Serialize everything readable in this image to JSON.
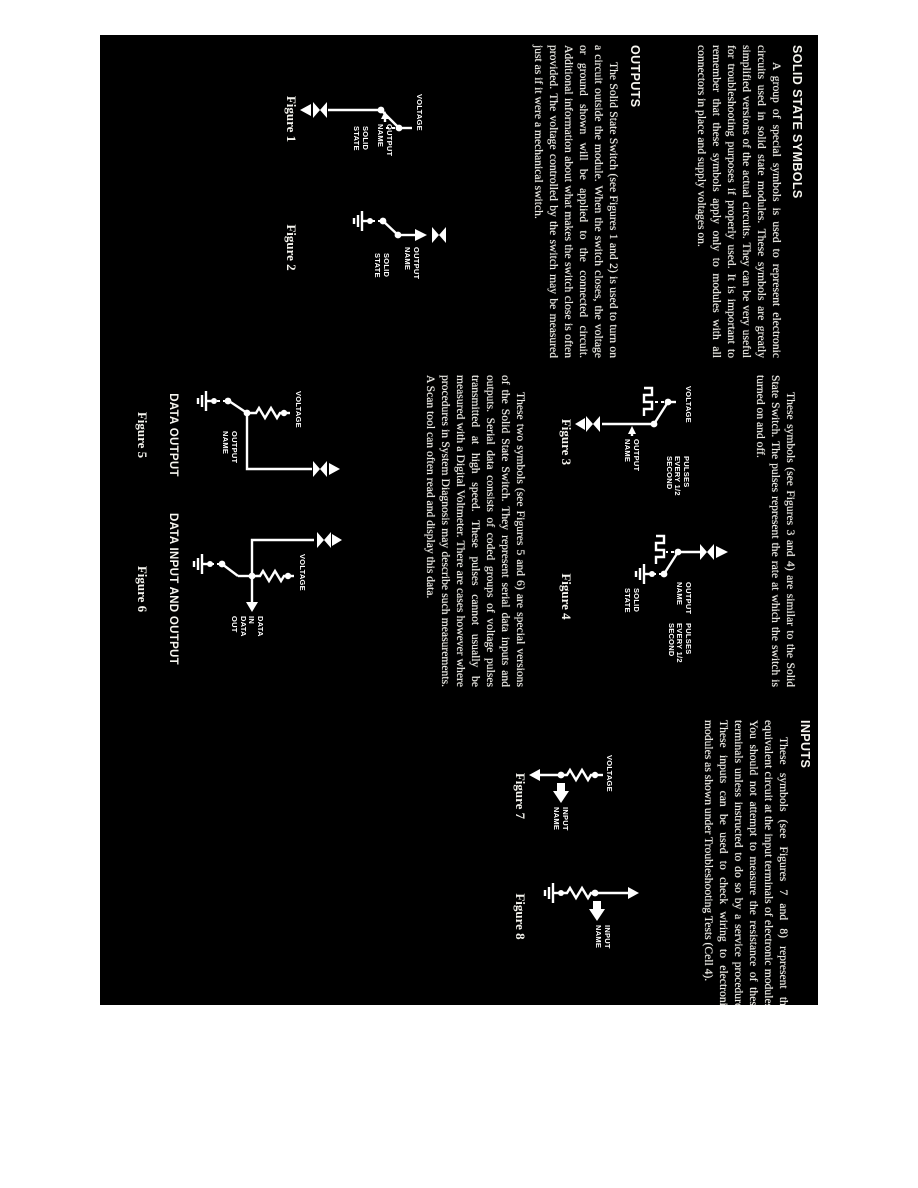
{
  "document": {
    "colors": {
      "paper": "#ffffff",
      "scan_bg": "#000000",
      "scan_text": "#f2f1ea"
    },
    "columns": {
      "col1": {
        "heading1": "SOLID STATE SYMBOLS",
        "para1": "A group of special symbols is used to represent electronic circuits used in solid state modules. These symbols are greatly simplified versions of the actual circuits. They can be very useful for troubleshooting purposes if properly used. It is important to remember that these symbols apply only to modules with all connectors in place and supply voltages on.",
        "heading2": "OUTPUTS",
        "para2": "The Solid State Switch (see Figures 1 and 2) is used to turn on a circuit outside the module. When the switch closes, the voltage or ground shown will be applied to the connected circuit. Additional information about what makes the switch close is often provided. The voltage controlled by the switch may be measured just as if it were a mechanical switch."
      },
      "col2": {
        "para1": "These symbols (see Figures 3 and 4) are similar to the Solid State Switch. The pulses represent the rate at which the switch is turned on and off.",
        "para2": "These two symbols (see Figures 5 and 6) are special versions of the Solid State Switch. They represent serial data inputs and outputs. Serial data consists of coded groups of voltage pulses transmitted at high speed. These pulses cannot usually be measured with a Digital Voltmeter. There are cases however where procedures in System Diagnosis may describe such measurements. A Scan tool can often read and display this data."
      },
      "col3": {
        "heading": "INPUTS",
        "para": "These symbols (see Figures 7 and 8) represent the equivalent circuit at the input terminals of electronic modules. You should not attempt to measure the resistance of these terminals unless instructed to do so by a service procedure. These inputs can be used to check wiring to electronic modules as shown under Troubleshooting Tests (Cell 4)."
      }
    },
    "figures": [
      {
        "caption": "Figure 1",
        "labels": {
          "voltage": "VOLTAGE",
          "output_name": "OUTPUT\nNAME",
          "solid_state": "SOLID\nSTATE"
        }
      },
      {
        "caption": "Figure 2",
        "labels": {
          "output_name": "OUTPUT\nNAME",
          "solid_state": "SOLID\nSTATE"
        }
      },
      {
        "caption": "Figure 3",
        "labels": {
          "voltage": "VOLTAGE",
          "pulses": "PULSES\nEVERY 1/2\nSECOND",
          "output_name": "OUTPUT\nNAME"
        }
      },
      {
        "caption": "Figure 4",
        "labels": {
          "output_name": "OUTPUT\nNAME",
          "pulses": "PULSES\nEVERY 1/2\nSECOND",
          "solid_state": "SOLID\nSTATE"
        }
      },
      {
        "caption": "Figure 5",
        "title": "DATA OUTPUT",
        "labels": {
          "voltage": "VOLTAGE",
          "output_name": "OUTPUT\nNAME"
        }
      },
      {
        "caption": "Figure 6",
        "title": "DATA INPUT AND OUTPUT",
        "labels": {
          "voltage": "VOLTAGE",
          "data": "DATA\nIN\nDATA\nOUT"
        }
      },
      {
        "caption": "Figure 7",
        "labels": {
          "voltage": "VOLTAGE",
          "input_name": "INPUT\nNAME"
        }
      },
      {
        "caption": "Figure 8",
        "labels": {
          "input_name": "INPUT\nNAME"
        }
      }
    ]
  }
}
